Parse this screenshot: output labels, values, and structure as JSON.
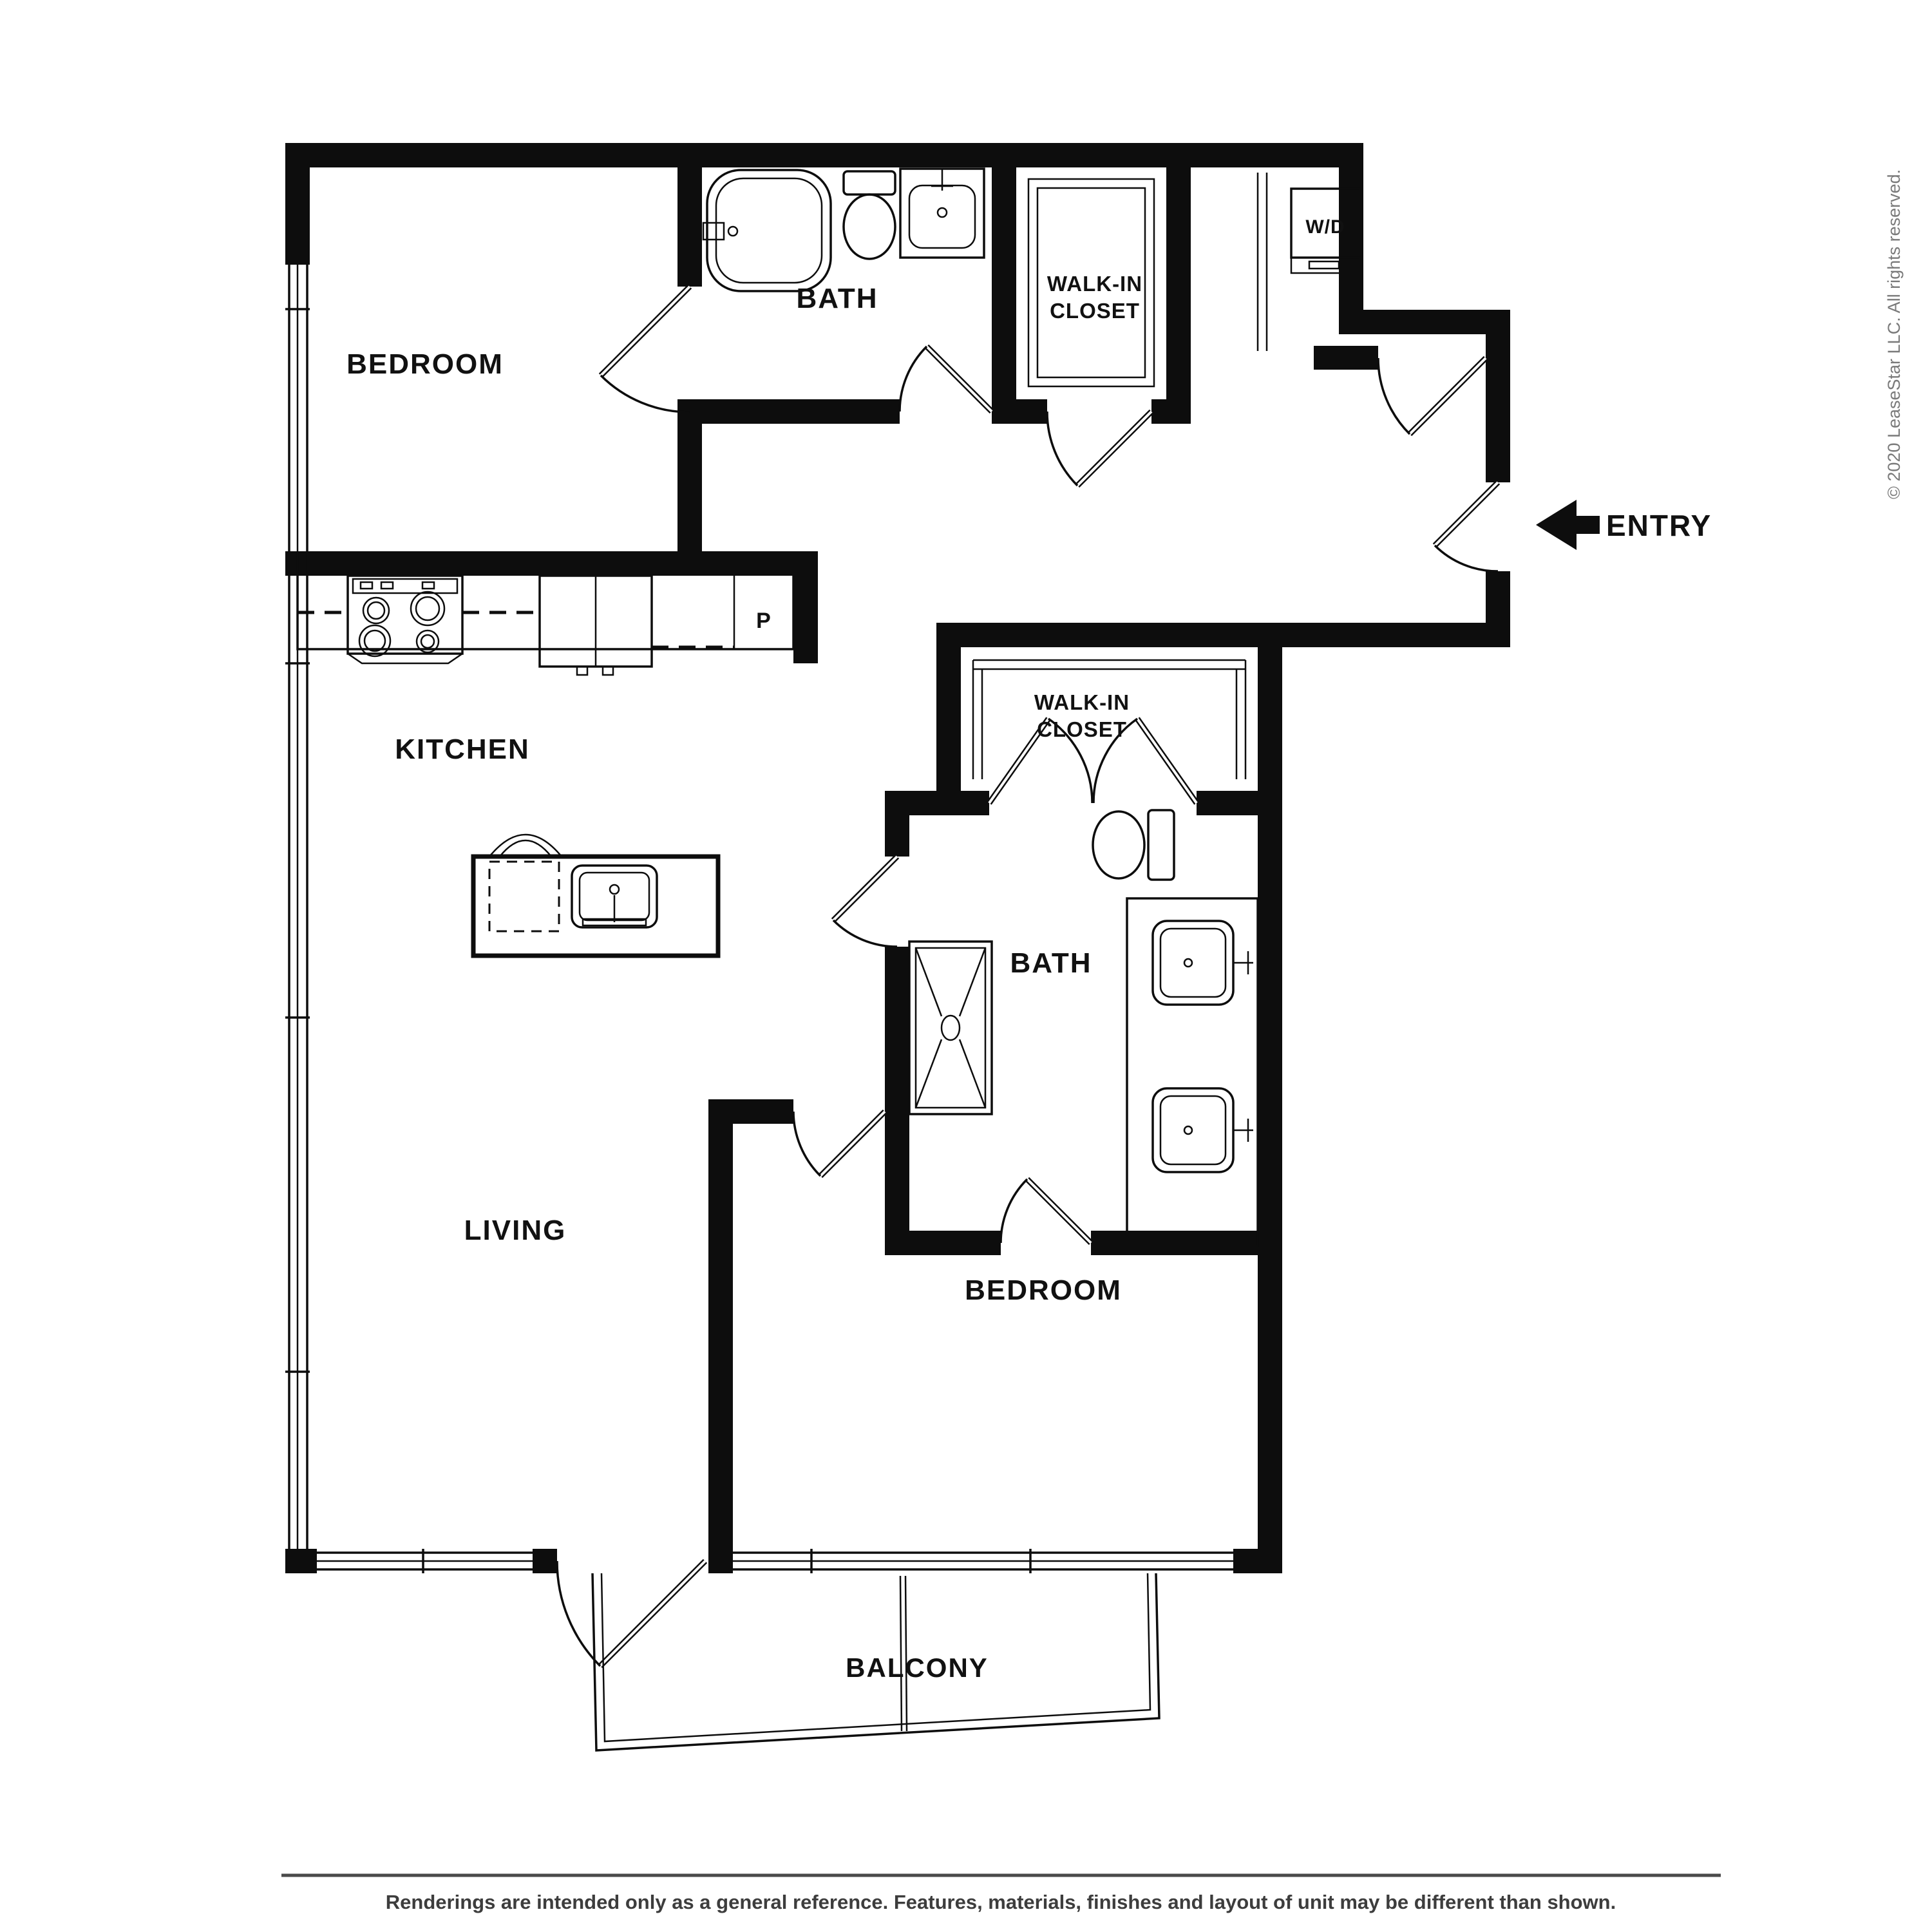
{
  "labels": {
    "bedroom1": "BEDROOM",
    "bath1": "BATH",
    "closet1_line1": "WALK-IN",
    "closet1_line2": "CLOSET",
    "washer_dryer": "W/D",
    "entry": "ENTRY",
    "kitchen": "KITCHEN",
    "pantry": "P",
    "closet2_line1": "WALK-IN",
    "closet2_line2": "CLOSET",
    "bath2": "BATH",
    "living": "LIVING",
    "bedroom2": "BEDROOM",
    "balcony": "BALCONY"
  },
  "footer": {
    "disclaimer": "Renderings are intended only as a general reference. Features, materials, finishes and layout of unit may be different than shown."
  },
  "copyright": {
    "text": "© 2020 LeaseStar LLC. All rights reserved."
  },
  "colors": {
    "wall": "#0d0d0d",
    "label": "#111111",
    "footer_text": "#3d3d3d",
    "copyright_text": "#7a7a7a",
    "background": "#ffffff"
  }
}
